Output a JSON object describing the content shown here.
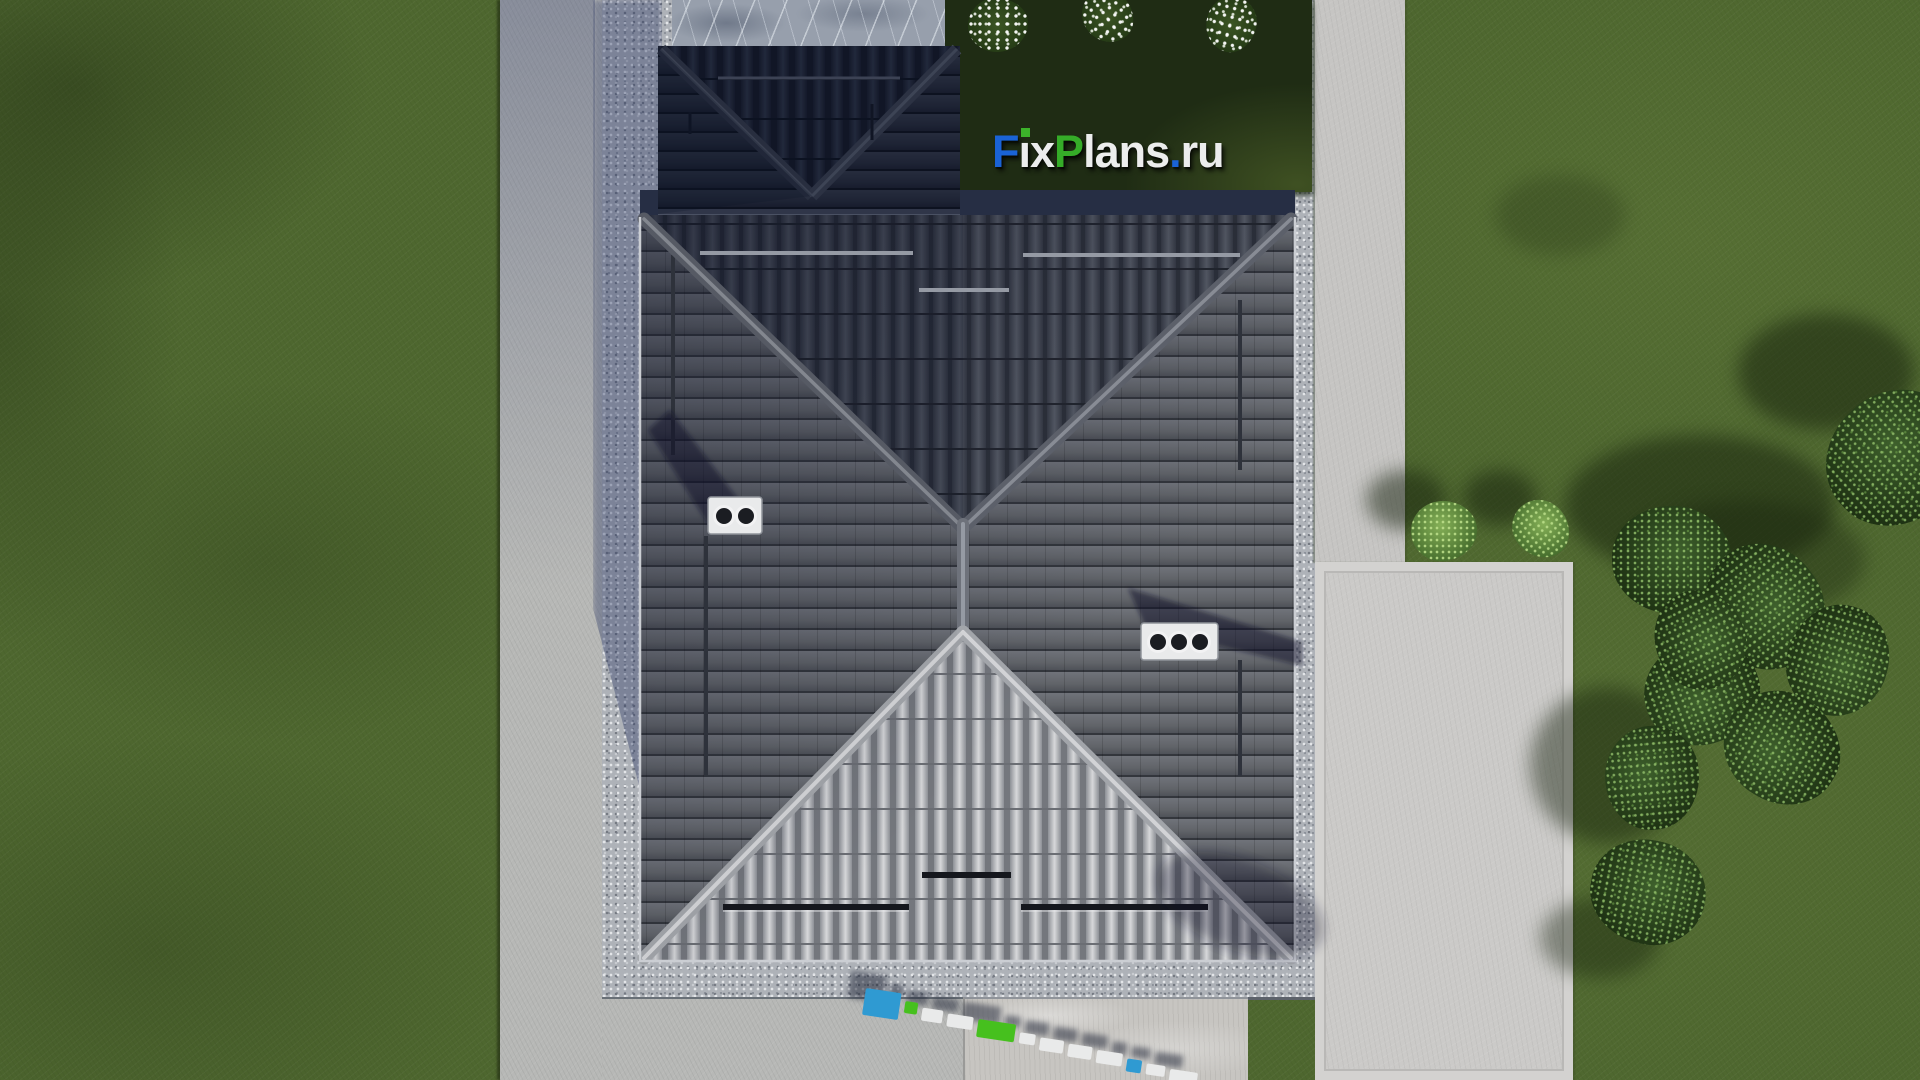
{
  "site": {
    "brand_text": "FixPlans.ru",
    "description_visible_text_only": "FixPlans.ru"
  },
  "logo": {
    "text": "FixPlans.ru",
    "letters": [
      {
        "ch": "F",
        "color": "#1a63d6"
      },
      {
        "ch": "ı",
        "color": "#eceded",
        "dot": "#3cb32a"
      },
      {
        "ch": "x",
        "color": "#eceded"
      },
      {
        "ch": "P",
        "color": "#35ac28"
      },
      {
        "ch": "l",
        "color": "#eceded"
      },
      {
        "ch": "a",
        "color": "#eceded"
      },
      {
        "ch": "n",
        "color": "#eceded"
      },
      {
        "ch": "s",
        "color": "#eceded"
      },
      {
        "ch": ".",
        "color": "#1a63d6"
      },
      {
        "ch": "r",
        "color": "#eceded"
      },
      {
        "ch": "u",
        "color": "#eceded"
      }
    ]
  },
  "watermark": {
    "text": "FixPlans.ru",
    "angle_deg": 8.5,
    "slabs": [
      {
        "color": "#2f9ad2",
        "w": 36,
        "h": 27,
        "dy": 0
      },
      {
        "color": "#46c01e",
        "w": 13,
        "h": 12,
        "dy": 7
      },
      {
        "color": "#e9eaea",
        "w": 21,
        "h": 13,
        "dy": 11
      },
      {
        "color": "#e9eaea",
        "w": 26,
        "h": 13,
        "dy": 13
      },
      {
        "color": "#46c01e",
        "w": 38,
        "h": 18,
        "dy": 14
      },
      {
        "color": "#e9eaea",
        "w": 16,
        "h": 11,
        "dy": 21
      },
      {
        "color": "#e9eaea",
        "w": 24,
        "h": 13,
        "dy": 23
      },
      {
        "color": "#e9eaea",
        "w": 24,
        "h": 13,
        "dy": 25
      },
      {
        "color": "#e9eaea",
        "w": 26,
        "h": 13,
        "dy": 27
      },
      {
        "color": "#2f9ad2",
        "w": 15,
        "h": 13,
        "dy": 31
      },
      {
        "color": "#e9eaea",
        "w": 19,
        "h": 11,
        "dy": 33
      },
      {
        "color": "#e9eaea",
        "w": 28,
        "h": 13,
        "dy": 35
      }
    ]
  },
  "house": {
    "roof_type": "hip",
    "chimneys": [
      {
        "vents": 2,
        "x": 708,
        "y": 497
      },
      {
        "vents": 3,
        "x": 1141,
        "y": 623
      }
    ],
    "snow_guards": true
  },
  "vegetation": {
    "flowers": [
      {
        "x": 998,
        "y": 25,
        "r": 30
      },
      {
        "x": 1108,
        "y": 16,
        "r": 27
      },
      {
        "x": 1231,
        "y": 24,
        "r": 28
      }
    ],
    "bushes": [
      {
        "x": 1444,
        "y": 531,
        "r": 33
      },
      {
        "x": 1541,
        "y": 529,
        "r": 30
      }
    ],
    "trees": [
      {
        "x": 1672,
        "y": 560,
        "r": 60
      },
      {
        "x": 1765,
        "y": 607,
        "r": 64
      },
      {
        "x": 1838,
        "y": 660,
        "r": 56
      },
      {
        "x": 1702,
        "y": 692,
        "r": 58
      },
      {
        "x": 1782,
        "y": 748,
        "r": 60
      },
      {
        "x": 1652,
        "y": 778,
        "r": 52
      },
      {
        "x": 1896,
        "y": 458,
        "r": 72
      },
      {
        "x": 1648,
        "y": 892,
        "r": 58
      },
      {
        "x": 1700,
        "y": 640,
        "r": 50
      }
    ],
    "shadows": [
      {
        "x": 1700,
        "y": 505,
        "rx": 135,
        "ry": 70,
        "o": 0.5
      },
      {
        "x": 1608,
        "y": 765,
        "rx": 78,
        "ry": 78,
        "o": 0.45
      },
      {
        "x": 1600,
        "y": 938,
        "rx": 60,
        "ry": 40,
        "o": 0.4
      },
      {
        "x": 1826,
        "y": 372,
        "rx": 88,
        "ry": 58,
        "o": 0.5
      },
      {
        "x": 1560,
        "y": 215,
        "rx": 65,
        "ry": 40,
        "o": 0.22
      },
      {
        "x": 1745,
        "y": 560,
        "rx": 120,
        "ry": 60,
        "o": 0.35
      },
      {
        "x": 1406,
        "y": 500,
        "rx": 40,
        "ry": 30,
        "o": 0.5
      },
      {
        "x": 1500,
        "y": 498,
        "rx": 37,
        "ry": 28,
        "o": 0.5
      }
    ]
  },
  "palette": {
    "grass": "#4e672f",
    "grass_shadow": "#1f2c14",
    "walkway": "#b7b8b6",
    "gravel": "#aeb2b8",
    "slab": "#c7c5c1",
    "pad": "#cbcac8",
    "roof_north": "#40444e",
    "roof_side": "#61646b",
    "roof_south_light": "#c6c7c9",
    "garage_roof": "#262b38",
    "stone_band": "#979fac",
    "chimney": "#e9eaeb",
    "logo_blue": "#1a63d6",
    "logo_green": "#35ac28",
    "watermark_blue": "#2f9ad2",
    "watermark_green": "#46c01e"
  }
}
